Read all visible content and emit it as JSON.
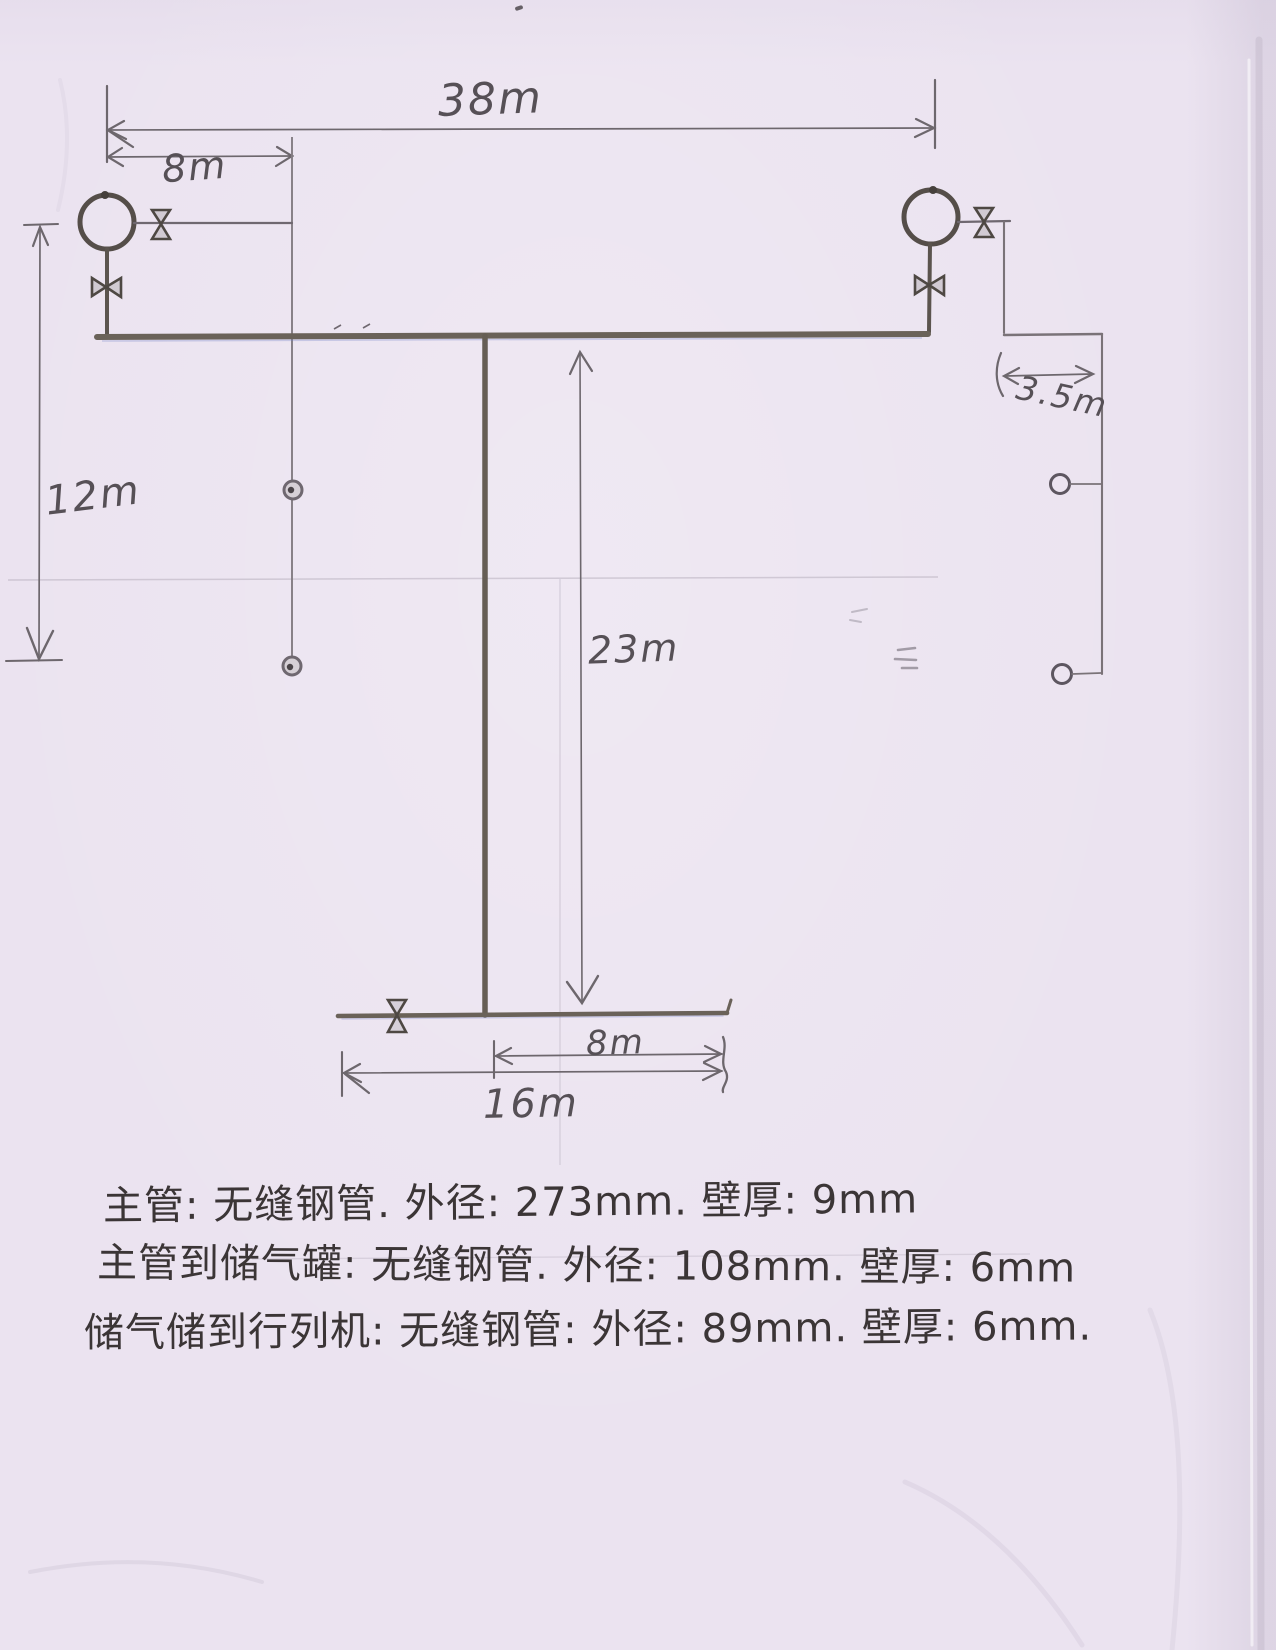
{
  "labels": {
    "dim_38m": "38m",
    "dim_8m_top": "8m",
    "dim_12m": "12m",
    "dim_23m": "23m",
    "dim_3_5m": "3.5m",
    "dim_8m_bottom": "8m",
    "dim_16m": "16m"
  },
  "notes": {
    "line1": "主管: 无缝钢管. 外径: 273mm. 壁厚: 9mm",
    "line2": "主管到储气罐: 无缝钢管. 外径: 108mm. 壁厚: 6mm",
    "line3": "储气储到行列机: 无缝钢管: 外径: 89mm. 壁厚: 6mm."
  },
  "icons": {
    "tank": "air-tank-circle-icon",
    "valve": "valve-bowtie-icon",
    "outlet": "outlet-circle-icon"
  },
  "colors": {
    "paper": "#ebe3f0",
    "pencil": "#6d676d",
    "pipe": "#6a6258",
    "ink": "#3b3536"
  }
}
